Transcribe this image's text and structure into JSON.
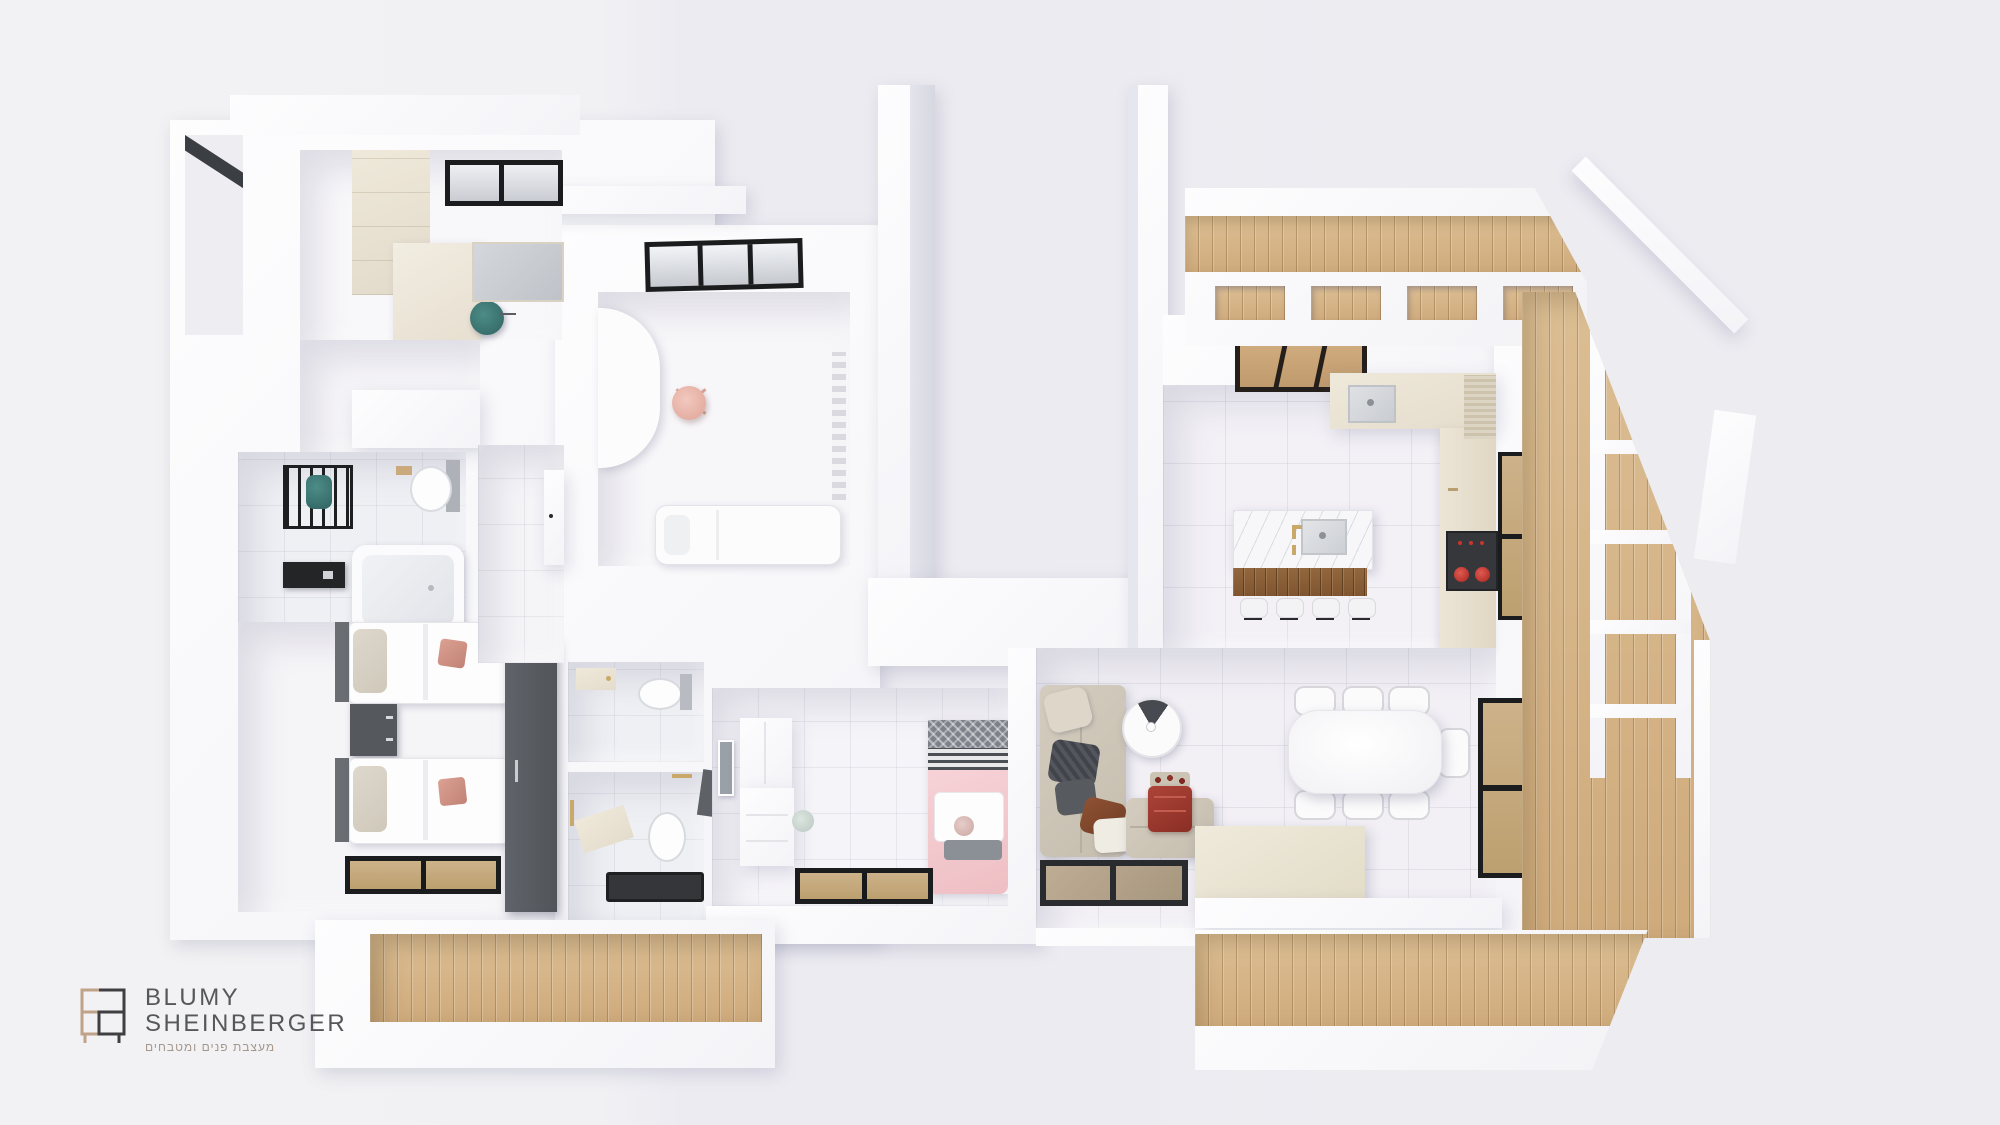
{
  "brand": {
    "line1": "BLUMY",
    "line2": "SHEINBERGER",
    "tagline": "מעצבת פנים ומטבחים",
    "icon": "furniture-outline-logo",
    "colors": {
      "icon_tan": "#bfa287",
      "icon_dark": "#3f3f41",
      "text": "#56575a",
      "tagline": "#a5978b"
    }
  },
  "scene": {
    "kind": "3d-top-down-apartment-render",
    "background": "#f0eff3",
    "palette": {
      "wall_white": "#fbfbfd",
      "floor_tile": "#f2f0f5",
      "bathroom_marble": "#eff0f4",
      "wood_deck": "#d5b285",
      "wood_island_front": "#8f6038",
      "window_frame": "#1b1c1e",
      "cabinet_cream": "#ebe4d5",
      "sofa_beige": "#cec6b7",
      "throw_red": "#9c382e",
      "stove_knob_red": "#c8352f",
      "girls_bed_pink": "#f3cbcf",
      "accent_pillow_pink": "#cf9285",
      "towel_teal": "#3c7b78",
      "desk_chair_pink": "#e9b8ae",
      "gold_fixture": "#c9a86a",
      "dark_furniture": "#55595e"
    },
    "rooms": [
      {
        "name": "study",
        "furniture": [
          "wall-cabinets",
          "desk",
          "teal-office-chair",
          "black-window",
          "frosted-window"
        ]
      },
      {
        "name": "bathroom",
        "furniture": [
          "towel-ladder",
          "teal-towel",
          "black-storage-unit",
          "bathtub",
          "toilet",
          "wood-shelf"
        ]
      },
      {
        "name": "kids-bedroom",
        "twin_beds": 2,
        "furniture": [
          "twin-bed",
          "twin-bed",
          "dark-nightstand",
          "dark-wardrobe",
          "floor-window-to-deck",
          "pink-accent-pillows"
        ]
      },
      {
        "name": "bedroom-with-desk",
        "furniture": [
          "black-window",
          "curved-white-desk",
          "pink-desk-chair",
          "radiator",
          "daybed"
        ]
      },
      {
        "name": "hallway",
        "furniture": [
          "built-in-cabinet"
        ]
      },
      {
        "name": "toilet-room",
        "furniture": [
          "toilet",
          "vanity"
        ]
      },
      {
        "name": "shower-room",
        "furniture": [
          "toilet",
          "vanity",
          "dark-shower-mat",
          "gold-towel-bars"
        ]
      },
      {
        "name": "girls-bedroom",
        "furniture": [
          "wall-mirror",
          "wardrobe",
          "desk",
          "stool",
          "pink-single-bed",
          "patterned-pillow",
          "plush-toy",
          "floor-window-to-deck"
        ]
      },
      {
        "name": "living-room",
        "furniture": [
          "corner-sofa",
          "cushions",
          "red-throw-blanket",
          "round-wall-art",
          "glass-coffee-table",
          "cream-ottoman-platform"
        ]
      },
      {
        "name": "kitchen",
        "bar_stools": 4,
        "furniture": [
          "marble-island-with-sink",
          "gold-faucet",
          "bar-stools",
          "corner-sink-counter",
          "tall-cream-cabinets",
          "cooktop-with-red-knobs",
          "wood-slat-skylight",
          "roller-shutter-cabinet",
          "window-to-deck"
        ]
      },
      {
        "name": "dining-area",
        "chairs": 7,
        "furniture": [
          "white-dining-table",
          "dining-chairs",
          "large-window-to-deck"
        ]
      },
      {
        "name": "balcony-top",
        "furniture": [
          "wood-deck",
          "railing-openings",
          "parapet"
        ]
      },
      {
        "name": "balcony-right",
        "furniture": [
          "wood-deck",
          "white-pergola-ladder-frame"
        ]
      },
      {
        "name": "balcony-bottom-left",
        "furniture": [
          "wood-deck"
        ]
      },
      {
        "name": "balcony-bottom-right",
        "furniture": [
          "wood-deck"
        ]
      }
    ]
  }
}
